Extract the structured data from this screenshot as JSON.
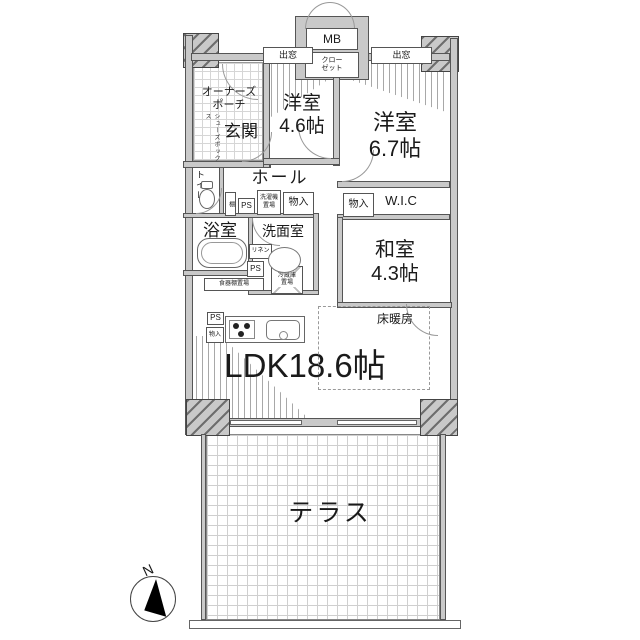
{
  "rooms": {
    "porch": "オーナーズ\nポーチ",
    "genkan": "玄関",
    "shoes_box": "シューズボックス",
    "bed1_name": "洋室",
    "bed1_size": "4.6帖",
    "bed2_name": "洋室",
    "bed2_size": "6.7帖",
    "washitsu_name": "和室",
    "washitsu_size": "4.3帖",
    "ldk": "LDK18.6帖",
    "terrace": "テラス",
    "hall": "ホール",
    "toilet": "トイレ",
    "bath": "浴室",
    "washroom": "洗面室",
    "wic": "W.I.C"
  },
  "fixtures": {
    "mb": "MB",
    "closet": "クロー\nゼット",
    "bay_left": "出窓",
    "bay_right": "出窓",
    "shelf": "棚",
    "ps_hall": "PS",
    "washer_place": "洗濯機\n置場",
    "monoire_hall": "物入",
    "monoire_wic": "物入",
    "linen": "リネン",
    "ps_wash": "PS",
    "fridge_place": "冷蔵庫\n置場",
    "cupboard_place": "食器棚置場",
    "ps_kitchen": "PS",
    "monoire_kitchen": "物入",
    "floor_heating": "床暖房"
  },
  "compass": {
    "north": "N"
  },
  "colors": {
    "wall": "#c9c9c9",
    "outline": "#555555",
    "text": "#1a1a1a",
    "grid": "#cfcfcf"
  }
}
